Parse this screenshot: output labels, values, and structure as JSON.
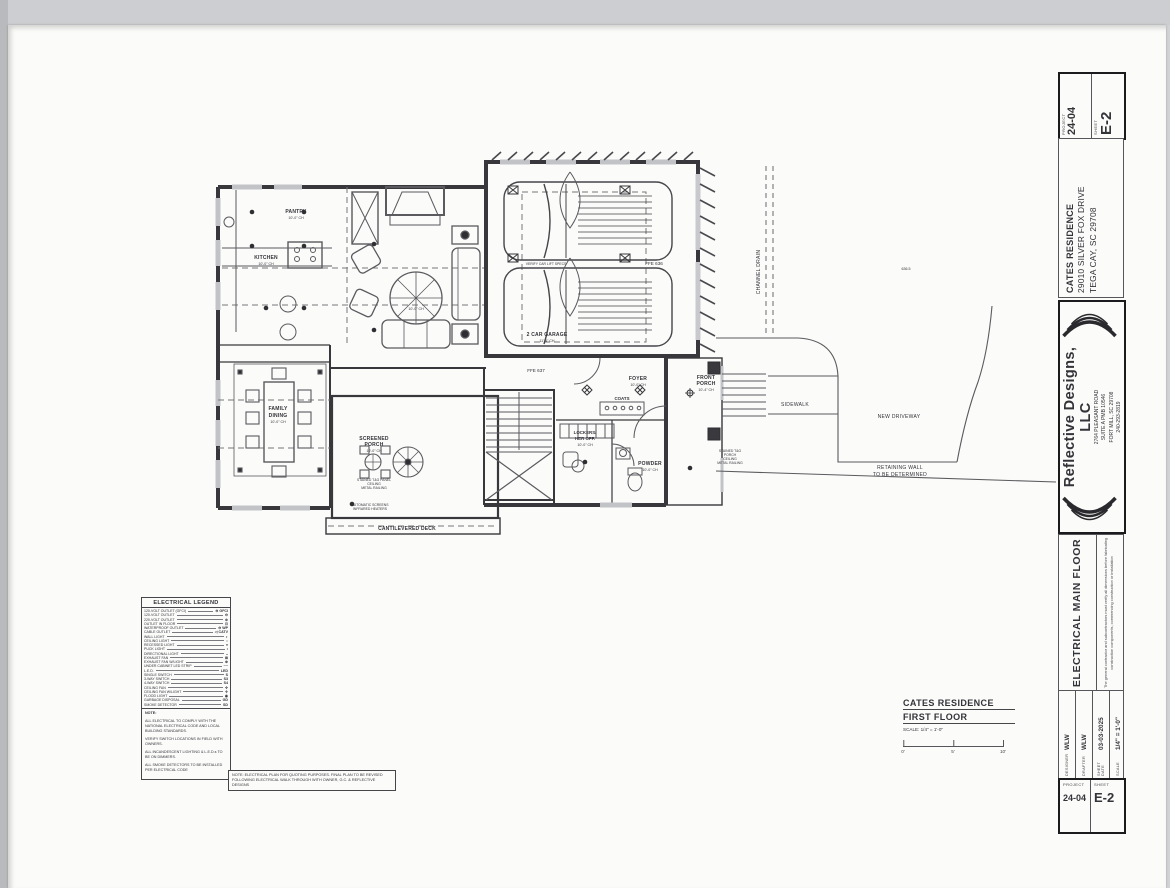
{
  "sheet": {
    "paper_color": "#fbfbf9",
    "bg_color": "#d2d3d6",
    "line_color": "#3a3a3e"
  },
  "titleblock": {
    "project_label": "PROJECT",
    "project_value": "24-04",
    "sheet_label": "SHEET",
    "sheet_value": "E-2",
    "client": {
      "line1": "CATES RESIDENCE",
      "line2": "29010 SILVER FOX DRIVE",
      "line3": "TEGA CAY, SC 29708"
    },
    "firm": {
      "name": "Reflective Designs, LLC",
      "addr1": "2764 PLEASANT ROAD",
      "addr2": "SUITE A PMB 10546",
      "addr3": "FORT MILL, SC 29708",
      "phone": "240-293-2819",
      "email": "WENDY@REFLECTIVE-DESIGNS.COM"
    },
    "sheet_title": "ELECTRICAL MAIN FLOOR",
    "disclaimer": "The general contractor and subcontractors must verify all dimensions before fabricating construction components, commencing construction or installation",
    "meta": [
      {
        "label": "DESIGNER",
        "value": "WLW"
      },
      {
        "label": "DRAFTER",
        "value": "WLW"
      },
      {
        "label": "SHEET DATE",
        "value": "03-03-2025"
      },
      {
        "label": "SCALE",
        "value": "1/4\" = 1'-0\""
      }
    ]
  },
  "legend": {
    "title": "ELECTRICAL LEGEND",
    "items": [
      {
        "label": "120-VOLT OUTLET (GFCI)",
        "sym": "⊖ GFCI"
      },
      {
        "label": "120-VOLT OUTLET",
        "sym": "⊖"
      },
      {
        "label": "220-VOLT OUTLET",
        "sym": "⊜"
      },
      {
        "label": "OUTLET IN FLOOR",
        "sym": "⊡"
      },
      {
        "label": "WATERPROOF OUTLET",
        "sym": "⊖ WP"
      },
      {
        "label": "CABLE OUTLET",
        "sym": "◁ CATV"
      },
      {
        "label": "WALL LIGHT",
        "sym": "◐"
      },
      {
        "label": "CEILING LIGHT",
        "sym": "○"
      },
      {
        "label": "RECESSED LIGHT",
        "sym": "●"
      },
      {
        "label": "PUCK LIGHT",
        "sym": "•"
      },
      {
        "label": "DIRECTIONAL LIGHT",
        "sym": "◒"
      },
      {
        "label": "EXHAUST FAN",
        "sym": "⊠"
      },
      {
        "label": "EXHAUST FAN W/LIGHT",
        "sym": "⊕"
      },
      {
        "label": "UNDER CABINET LED STRIP",
        "sym": "┄┄"
      },
      {
        "label": "L.E.D.",
        "sym": "LED"
      },
      {
        "label": "SINGLE SWITCH",
        "sym": "S"
      },
      {
        "label": "3-WAY SWITCH",
        "sym": "S3"
      },
      {
        "label": "4-WAY SWITCH",
        "sym": "S4"
      },
      {
        "label": "CEILING FAN",
        "sym": "✣"
      },
      {
        "label": "CEILING FAN W/LIGHT",
        "sym": "✢"
      },
      {
        "label": "FLOOD LIGHT",
        "sym": "◉"
      },
      {
        "label": "GARBAGE DISPOSAL",
        "sym": "GD"
      },
      {
        "label": "SMOKE DETECTOR",
        "sym": "SD"
      }
    ],
    "note_label": "NOTE:",
    "notes": [
      "ALL ELECTRICAL TO COMPLY WITH THE NATIONAL ELECTRICAL CODE AND LOCAL BUILDING STANDARDS.",
      "VERIFY SWITCH LOCATIONS IN FIELD WITH OWNERS.",
      "ALL INCANDESCENT LIGHTING & L.E.D.s TO BE ON DIMMERS.",
      "ALL SMOKE DETECTORS TO BE INSTALLED PER ELECTRICAL CODE"
    ]
  },
  "footnote": "NOTE:  ELECTRICAL PLAN FOR QUOTING PURPOSES. FINAL PLAN TO BE REVISED FOLLOWING ELECTRICAL WALK THROUGH WITH OWNER, G.C. & REFLECTIVE DESIGNS",
  "drawing_title": {
    "line1": "CATES RESIDENCE",
    "line2": "FIRST FLOOR",
    "scale": "SCALE: 1/4\" = 1'-0\"",
    "bar": [
      "0'",
      "5'",
      "10'"
    ]
  },
  "plan": {
    "labels": {
      "pantry": "PANTRY",
      "pantry_ch": "10'-0\" CH",
      "kitchen": "KITCHEN",
      "kitchen_ch": "10'-0\" CH",
      "living_ch": "10'-0\" CH",
      "garage": "2 CAR GARAGE",
      "garage_ch": "11'-4\" CH",
      "ffe_garage": "FFE 636",
      "lift": "VERIFY CAR LIFT SPECS",
      "ffe_main": "FFE 637",
      "foyer": "FOYER",
      "foyer_ch": "10'-0\" CH",
      "coats": "COATS",
      "lockers_a": "LOCKERS/",
      "lockers_b": "HER OFF.",
      "lockers_ch": "10'-0\" CH",
      "powder": "POWDER",
      "powder_ch": "10'-0\" CH",
      "porch_a": "FRONT",
      "porch_b": "PORCH",
      "porch_ch": "10'-4\" CH",
      "family_a": "FAMILY",
      "family_b": "DINING",
      "family_ch": "10'-0\" CH",
      "scr_a": "SCREENED",
      "scr_b": "PORCH",
      "scr_ch": "10'-0\" CH",
      "scr_note_a": "STAINED T&G PANEL",
      "scr_note_b": "CEILING",
      "scr_note_c": "METAL RAILING",
      "auto_a": "AUTOMATIC SCREENS",
      "auto_b": "INFRARED HEATERS",
      "deck": "CANTILEVERED DECK",
      "stained_a": "STAINED T&G",
      "stained_b": "PORCH",
      "stained_c": "CEILING",
      "stained_d": "METAL RAILING",
      "sidewalk": "SIDEWALK",
      "driveway": "NEW DRIVEWAY",
      "retaining_a": "RETAINING WALL",
      "retaining_b": "TO BE DETERMINED",
      "channel": "CHANNEL DRAIN",
      "elev": "636.5"
    }
  }
}
